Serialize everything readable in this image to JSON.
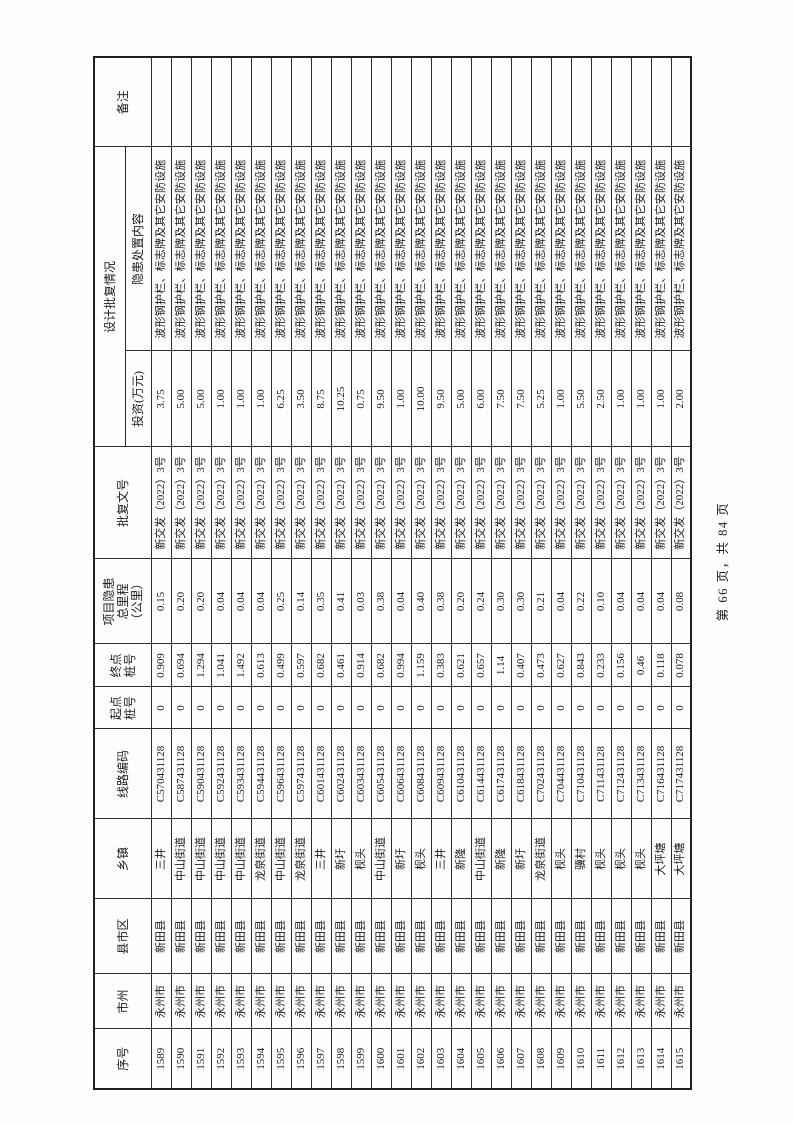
{
  "page": {
    "footer": "第 66 页，共 84 页"
  },
  "table": {
    "headers": {
      "no": "序号",
      "city": "市州",
      "county": "县市区",
      "town": "乡镇",
      "code": "线路编码",
      "start": "起点\n桩号",
      "end": "终点\n桩号",
      "mileage": "项目隐患\n总里程\n（公里）",
      "doc": "批复文号",
      "design_group": "设计批复情况",
      "invest": "投资(万元)",
      "content": "隐患处置内容",
      "remark": "备注"
    },
    "rows": [
      {
        "no": "1589",
        "city": "永州市",
        "county": "新田县",
        "town": "三井",
        "code": "C570431128",
        "start": "0",
        "end": "0.909",
        "mileage": "0.15",
        "doc": "新交发（2022）3号",
        "invest": "3.75",
        "content": "波形钢护栏、标志牌及其它安防设施",
        "remark": ""
      },
      {
        "no": "1590",
        "city": "永州市",
        "county": "新田县",
        "town": "中山街道",
        "code": "C587431128",
        "start": "0",
        "end": "0.694",
        "mileage": "0.20",
        "doc": "新交发（2022）3号",
        "invest": "5.00",
        "content": "波形钢护栏、标志牌及其它安防设施",
        "remark": ""
      },
      {
        "no": "1591",
        "city": "永州市",
        "county": "新田县",
        "town": "中山街道",
        "code": "C590431128",
        "start": "0",
        "end": "1.294",
        "mileage": "0.20",
        "doc": "新交发（2022）3号",
        "invest": "5.00",
        "content": "波形钢护栏、标志牌及其它安防设施",
        "remark": ""
      },
      {
        "no": "1592",
        "city": "永州市",
        "county": "新田县",
        "town": "中山街道",
        "code": "C592431128",
        "start": "0",
        "end": "1.041",
        "mileage": "0.04",
        "doc": "新交发（2022）3号",
        "invest": "1.00",
        "content": "波形钢护栏、标志牌及其它安防设施",
        "remark": ""
      },
      {
        "no": "1593",
        "city": "永州市",
        "county": "新田县",
        "town": "中山街道",
        "code": "C593431128",
        "start": "0",
        "end": "1.492",
        "mileage": "0.04",
        "doc": "新交发（2022）3号",
        "invest": "1.00",
        "content": "波形钢护栏、标志牌及其它安防设施",
        "remark": ""
      },
      {
        "no": "1594",
        "city": "永州市",
        "county": "新田县",
        "town": "龙泉街道",
        "code": "C594431128",
        "start": "0",
        "end": "0.613",
        "mileage": "0.04",
        "doc": "新交发（2022）3号",
        "invest": "1.00",
        "content": "波形钢护栏、标志牌及其它安防设施",
        "remark": ""
      },
      {
        "no": "1595",
        "city": "永州市",
        "county": "新田县",
        "town": "中山街道",
        "code": "C596431128",
        "start": "0",
        "end": "0.499",
        "mileage": "0.25",
        "doc": "新交发（2022）3号",
        "invest": "6.25",
        "content": "波形钢护栏、标志牌及其它安防设施",
        "remark": ""
      },
      {
        "no": "1596",
        "city": "永州市",
        "county": "新田县",
        "town": "龙泉街道",
        "code": "C597431128",
        "start": "0",
        "end": "0.597",
        "mileage": "0.14",
        "doc": "新交发（2022）3号",
        "invest": "3.50",
        "content": "波形钢护栏、标志牌及其它安防设施",
        "remark": ""
      },
      {
        "no": "1597",
        "city": "永州市",
        "county": "新田县",
        "town": "三井",
        "code": "C601431128",
        "start": "0",
        "end": "0.682",
        "mileage": "0.35",
        "doc": "新交发（2022）3号",
        "invest": "8.75",
        "content": "波形钢护栏、标志牌及其它安防设施",
        "remark": ""
      },
      {
        "no": "1598",
        "city": "永州市",
        "county": "新田县",
        "town": "新圩",
        "code": "C602431128",
        "start": "0",
        "end": "0.461",
        "mileage": "0.41",
        "doc": "新交发（2022）3号",
        "invest": "10.25",
        "content": "波形钢护栏、标志牌及其它安防设施",
        "remark": ""
      },
      {
        "no": "1599",
        "city": "永州市",
        "county": "新田县",
        "town": "枧头",
        "code": "C603431128",
        "start": "0",
        "end": "0.914",
        "mileage": "0.03",
        "doc": "新交发（2022）3号",
        "invest": "0.75",
        "content": "波形钢护栏、标志牌及其它安防设施",
        "remark": ""
      },
      {
        "no": "1600",
        "city": "永州市",
        "county": "新田县",
        "town": "中山街道",
        "code": "C605431128",
        "start": "0",
        "end": "0.682",
        "mileage": "0.38",
        "doc": "新交发（2022）3号",
        "invest": "9.50",
        "content": "波形钢护栏、标志牌及其它安防设施",
        "remark": ""
      },
      {
        "no": "1601",
        "city": "永州市",
        "county": "新田县",
        "town": "新圩",
        "code": "C606431128",
        "start": "0",
        "end": "0.994",
        "mileage": "0.04",
        "doc": "新交发（2022）3号",
        "invest": "1.00",
        "content": "波形钢护栏、标志牌及其它安防设施",
        "remark": ""
      },
      {
        "no": "1602",
        "city": "永州市",
        "county": "新田县",
        "town": "枧头",
        "code": "C608431128",
        "start": "0",
        "end": "1.159",
        "mileage": "0.40",
        "doc": "新交发（2022）3号",
        "invest": "10.00",
        "content": "波形钢护栏、标志牌及其它安防设施",
        "remark": ""
      },
      {
        "no": "1603",
        "city": "永州市",
        "county": "新田县",
        "town": "三井",
        "code": "C609431128",
        "start": "0",
        "end": "0.383",
        "mileage": "0.38",
        "doc": "新交发（2022）3号",
        "invest": "9.50",
        "content": "波形钢护栏、标志牌及其它安防设施",
        "remark": ""
      },
      {
        "no": "1604",
        "city": "永州市",
        "county": "新田县",
        "town": "新隆",
        "code": "C610431128",
        "start": "0",
        "end": "0.621",
        "mileage": "0.20",
        "doc": "新交发（2022）3号",
        "invest": "5.00",
        "content": "波形钢护栏、标志牌及其它安防设施",
        "remark": ""
      },
      {
        "no": "1605",
        "city": "永州市",
        "county": "新田县",
        "town": "中山街道",
        "code": "C614431128",
        "start": "0",
        "end": "0.657",
        "mileage": "0.24",
        "doc": "新交发（2022）3号",
        "invest": "6.00",
        "content": "波形钢护栏、标志牌及其它安防设施",
        "remark": ""
      },
      {
        "no": "1606",
        "city": "永州市",
        "county": "新田县",
        "town": "新隆",
        "code": "C617431128",
        "start": "0",
        "end": "1.14",
        "mileage": "0.30",
        "doc": "新交发（2022）3号",
        "invest": "7.50",
        "content": "波形钢护栏、标志牌及其它安防设施",
        "remark": ""
      },
      {
        "no": "1607",
        "city": "永州市",
        "county": "新田县",
        "town": "新圩",
        "code": "C618431128",
        "start": "0",
        "end": "0.407",
        "mileage": "0.30",
        "doc": "新交发（2022）3号",
        "invest": "7.50",
        "content": "波形钢护栏、标志牌及其它安防设施",
        "remark": ""
      },
      {
        "no": "1608",
        "city": "永州市",
        "county": "新田县",
        "town": "龙泉街道",
        "code": "C702431128",
        "start": "0",
        "end": "0.473",
        "mileage": "0.21",
        "doc": "新交发（2022）3号",
        "invest": "5.25",
        "content": "波形钢护栏、标志牌及其它安防设施",
        "remark": ""
      },
      {
        "no": "1609",
        "city": "永州市",
        "county": "新田县",
        "town": "枧头",
        "code": "C704431128",
        "start": "0",
        "end": "0.627",
        "mileage": "0.04",
        "doc": "新交发（2022）3号",
        "invest": "1.00",
        "content": "波形钢护栏、标志牌及其它安防设施",
        "remark": ""
      },
      {
        "no": "1610",
        "city": "永州市",
        "county": "新田县",
        "town": "骥村",
        "code": "C710431128",
        "start": "0",
        "end": "0.843",
        "mileage": "0.22",
        "doc": "新交发（2022）3号",
        "invest": "5.50",
        "content": "波形钢护栏、标志牌及其它安防设施",
        "remark": ""
      },
      {
        "no": "1611",
        "city": "永州市",
        "county": "新田县",
        "town": "枧头",
        "code": "C711431128",
        "start": "0",
        "end": "0.233",
        "mileage": "0.10",
        "doc": "新交发（2022）3号",
        "invest": "2.50",
        "content": "波形钢护栏、标志牌及其它安防设施",
        "remark": ""
      },
      {
        "no": "1612",
        "city": "永州市",
        "county": "新田县",
        "town": "枧头",
        "code": "C712431128",
        "start": "0",
        "end": "0.156",
        "mileage": "0.04",
        "doc": "新交发（2022）3号",
        "invest": "1.00",
        "content": "波形钢护栏、标志牌及其它安防设施",
        "remark": ""
      },
      {
        "no": "1613",
        "city": "永州市",
        "county": "新田县",
        "town": "枧头",
        "code": "C713431128",
        "start": "0",
        "end": "0.46",
        "mileage": "0.04",
        "doc": "新交发（2022）3号",
        "invest": "1.00",
        "content": "波形钢护栏、标志牌及其它安防设施",
        "remark": ""
      },
      {
        "no": "1614",
        "city": "永州市",
        "county": "新田县",
        "town": "大坪塘",
        "code": "C716431128",
        "start": "0",
        "end": "0.118",
        "mileage": "0.04",
        "doc": "新交发（2022）3号",
        "invest": "1.00",
        "content": "波形钢护栏、标志牌及其它安防设施",
        "remark": ""
      },
      {
        "no": "1615",
        "city": "永州市",
        "county": "新田县",
        "town": "大坪塘",
        "code": "C717431128",
        "start": "0",
        "end": "0.078",
        "mileage": "0.08",
        "doc": "新交发（2022）3号",
        "invest": "2.00",
        "content": "波形钢护栏、标志牌及其它安防设施",
        "remark": ""
      }
    ]
  }
}
